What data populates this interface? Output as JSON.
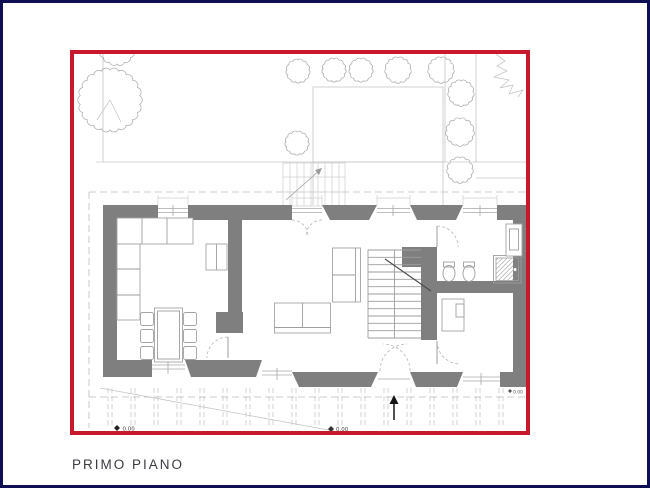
{
  "title": {
    "label": "PRIMO PIANO"
  },
  "markers": {
    "level_left": "0.00",
    "level_center": "0.00",
    "level_right": "0.00"
  },
  "colors": {
    "frame": "#0e0e55",
    "plan_border": "#c9182b",
    "wall": "#7f7f7f",
    "text": "#3b3b42"
  }
}
